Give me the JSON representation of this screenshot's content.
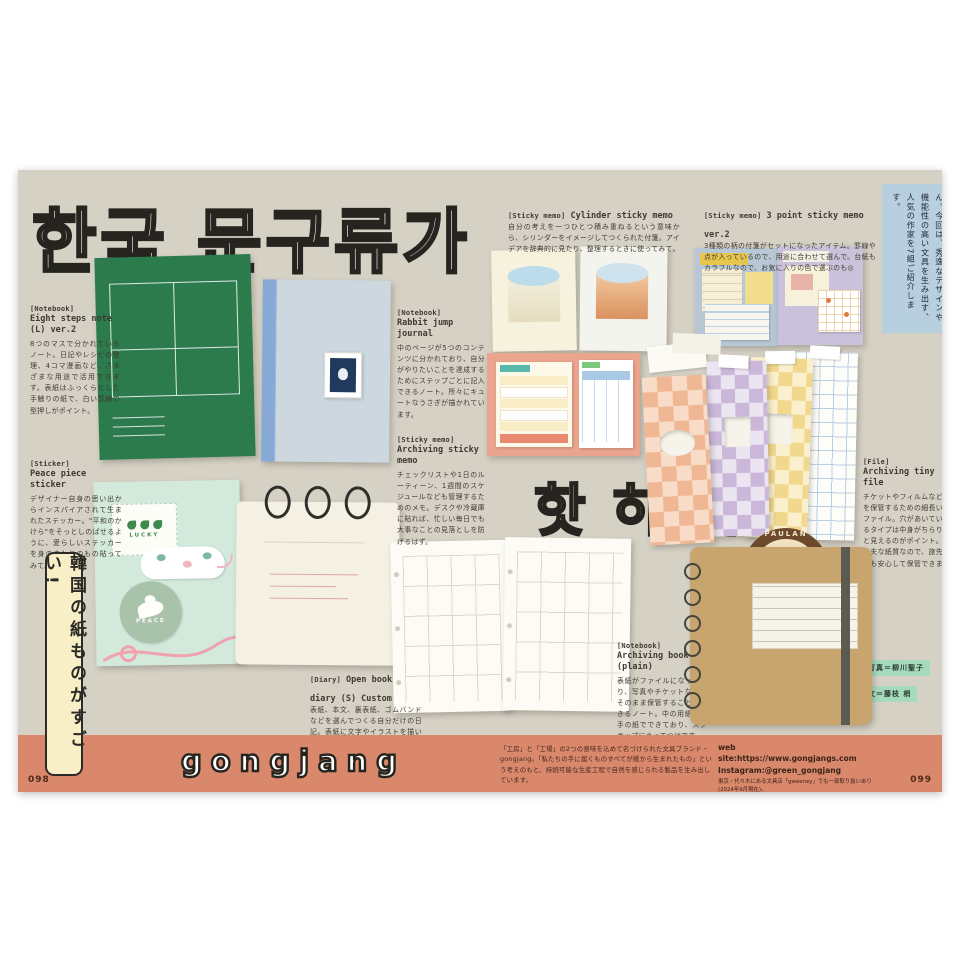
{
  "titles": {
    "main_korean": "한국 문구류가",
    "sub_korean": "핫 하 다 !",
    "side_banner": "韓国の紙ものがすごい!"
  },
  "intro_box": {
    "text": "音楽やドラマ、ファッションなど、多様なジャンルでブームを生み出している韓国。もちろん紙ものだって例外ではありません。今回は、秀逸なデザインや機能性の高い文具を生み出す、人気の作家を7組ご紹介します。"
  },
  "captions": {
    "eight_steps": {
      "tag": "[Notebook]",
      "title": "Eight steps note (L) ver.2",
      "body": "8つのマスで分かれているノート。日記やレシピの整理、4コマ漫画など、さまざまな用途で活用できます。表紙はふっくらとした手触りの紙で、白い罫線の型押しがポイント。"
    },
    "peace": {
      "tag": "[Sticker]",
      "title": "Peace piece sticker",
      "body": "デザイナー自身の思い出からインスパイアされて生まれたステッカー。\"平和のかけら\"をそっとしのばせるように、愛らしいステッカーを身のまわりのもの貼ってみて。"
    },
    "rabbit": {
      "tag": "[Notebook]",
      "title": "Rabbit jump journal",
      "body": "中のページが5つのコンテンツに分かれており、自分がやりたいことを達成するためにステップごとに記入できるノート。所々にキュートなうさぎが描かれています。"
    },
    "archiving_memo": {
      "tag": "[Sticky memo]",
      "title": "Archiving sticky memo",
      "body": "チェックリストや1日のルーティーン、1週間のスケジュールなども管理するためのメモ。デスクや冷蔵庫に貼れば、忙しい毎日でも大事なことの見落としを防げるはず。"
    },
    "diary": {
      "tag": "[Diary]",
      "title": "Open book diary (S) Custom",
      "body": "表紙、本文、裏表紙、ゴムバンドなどを選んでつくる自分だけの日記。表紙に文字やイラストを描いたりシールを貼ったり、アレンジを加えることで唯一無二のアイテムに。"
    },
    "cylinder": {
      "tag": "[Sticky memo]",
      "title": "Cylinder sticky memo",
      "body": "自分の考えを一つひとつ積み重ねるという意味から、シリンダーをイメージしてつくられた付箋。アイデアを辞典的に見たり、整理するときに使ってみて。"
    },
    "three_point": {
      "tag": "[Sticky memo]",
      "title": "3 point sticky memo ver.2",
      "body": "3種類の柄の付箋がセットになったアイテム。罫線や点が入っているので、用途に合わせて選んで。台紙もカラフルなので、お気に入りの色で選ぶのも◎"
    },
    "tiny_file": {
      "tag": "[File]",
      "title": "Archiving tiny file",
      "body": "チケットやフィルムなどを保管するための細長いファイル。穴があいているタイプは中身がちらりと見えるのがポイント。丈夫な紙質なので、旅先でも安心して保管できます。"
    },
    "archiving_book": {
      "tag": "[Notebook]",
      "title": "Archiving book (plain)",
      "body": "表紙がファイルになっており、写真やチケットなどをそのまま保管することができるノート。中の用紙は厚手の紙でできており、スクラップにうってつけです。"
    }
  },
  "product_labels": {
    "lucky": "LUCKY",
    "peace": "PEACE",
    "bread": "PAULAN"
  },
  "credits": {
    "photo": "写真＝柳川聖子",
    "text": "文＝藤枝 梢"
  },
  "footer": {
    "brand": "gongjang",
    "description": "「工房」と「工場」の2つの意味を込めて名づけられた文具ブランド・gongjang。「私たちの手に届くものすべてが紙から生まれたもの」という考えのもと、持続可能な生産工程で自然を感じられる製品を生み出しています。",
    "website": "web site:https://www.gongjangs.com",
    "instagram": "Instagram:@green_gongjang",
    "note": "東京・代々木にある文具店「gweeney」でも一部取り扱いあり(2024年9月現在)。",
    "left_page_number": "098",
    "right_page_number": "099"
  },
  "colors": {
    "spread_bg": "#d5d1c5",
    "footer_bar": "#d9886c",
    "intro_box_bg": "#b7cfdf",
    "side_banner_bg": "#f8efc6",
    "green_notebook": "#2b7b4d",
    "kraft": "#c8a46f",
    "credit_badge": "#a5dabd"
  }
}
